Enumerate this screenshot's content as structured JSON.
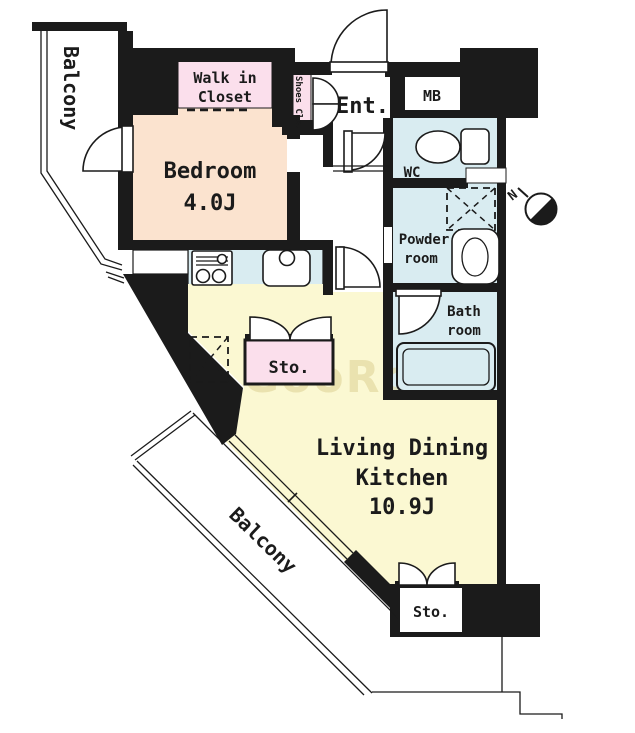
{
  "rooms": {
    "balcony_top": {
      "label": "Balcony"
    },
    "walk_in_closet": {
      "line1": "Walk in",
      "line2": "Closet"
    },
    "shoes_closet": {
      "label": "Shoes Clo."
    },
    "entrance": {
      "label": "Ent."
    },
    "meter_box": {
      "label": "MB"
    },
    "bedroom": {
      "name": "Bedroom",
      "size": "4.0J"
    },
    "wc": {
      "label": "WC"
    },
    "powder_room": {
      "line1": "Powder",
      "line2": "room"
    },
    "bath_room": {
      "line1": "Bath",
      "line2": "room"
    },
    "storage_upper": {
      "label": "Sto."
    },
    "living_dining_kitchen": {
      "line1": "Living Dining",
      "line2": "Kitchen",
      "size": "10.9J"
    },
    "balcony_lower": {
      "label": "Balcony"
    },
    "storage_lower": {
      "label": "Sto."
    }
  },
  "compass": {
    "north_label": "N"
  },
  "watermark": {
    "text": "GooRooM"
  },
  "colors": {
    "wall": "#1b1b1b",
    "bedroom": "#fbe3cf",
    "ldk": "#fbf8d2",
    "wet_rooms": "#d9ecf1",
    "closets": "#fbdfec",
    "watermark": "#ddd194",
    "background": "#ffffff"
  }
}
